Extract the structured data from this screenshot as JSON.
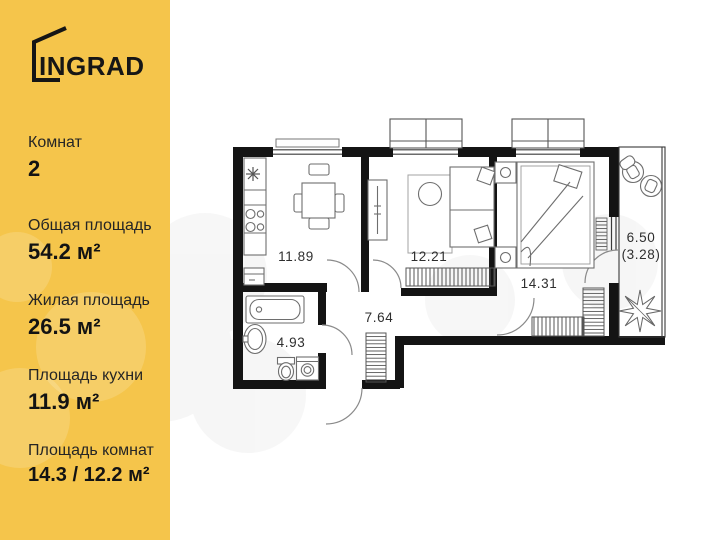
{
  "sidebar": {
    "logo_text": "INGRAD",
    "stats": [
      {
        "label": "Комнат",
        "value": "2"
      },
      {
        "label": "Общая площадь",
        "value": "54.2 м²"
      },
      {
        "label": "Жилая площадь",
        "value": "26.5 м²"
      },
      {
        "label": "Площадь кухни",
        "value": "11.9 м²"
      },
      {
        "label": "Площадь комнат",
        "value": "14.3 / 12.2 м²"
      }
    ]
  },
  "floorplan": {
    "rooms": [
      {
        "name": "kitchen",
        "area": "11.89"
      },
      {
        "name": "bedroom-1",
        "area": "12.21"
      },
      {
        "name": "bedroom-2",
        "area": "14.31"
      },
      {
        "name": "hallway",
        "area": "7.64"
      },
      {
        "name": "bathroom",
        "area": "4.93"
      },
      {
        "name": "balcony",
        "area": "6.50",
        "area_secondary": "(3.28)"
      }
    ]
  },
  "colors": {
    "sidebar_bg": "#F5C54B",
    "text": "#1A1A1A",
    "wall": "#141414",
    "plan_bg": "#FFFFFF"
  }
}
